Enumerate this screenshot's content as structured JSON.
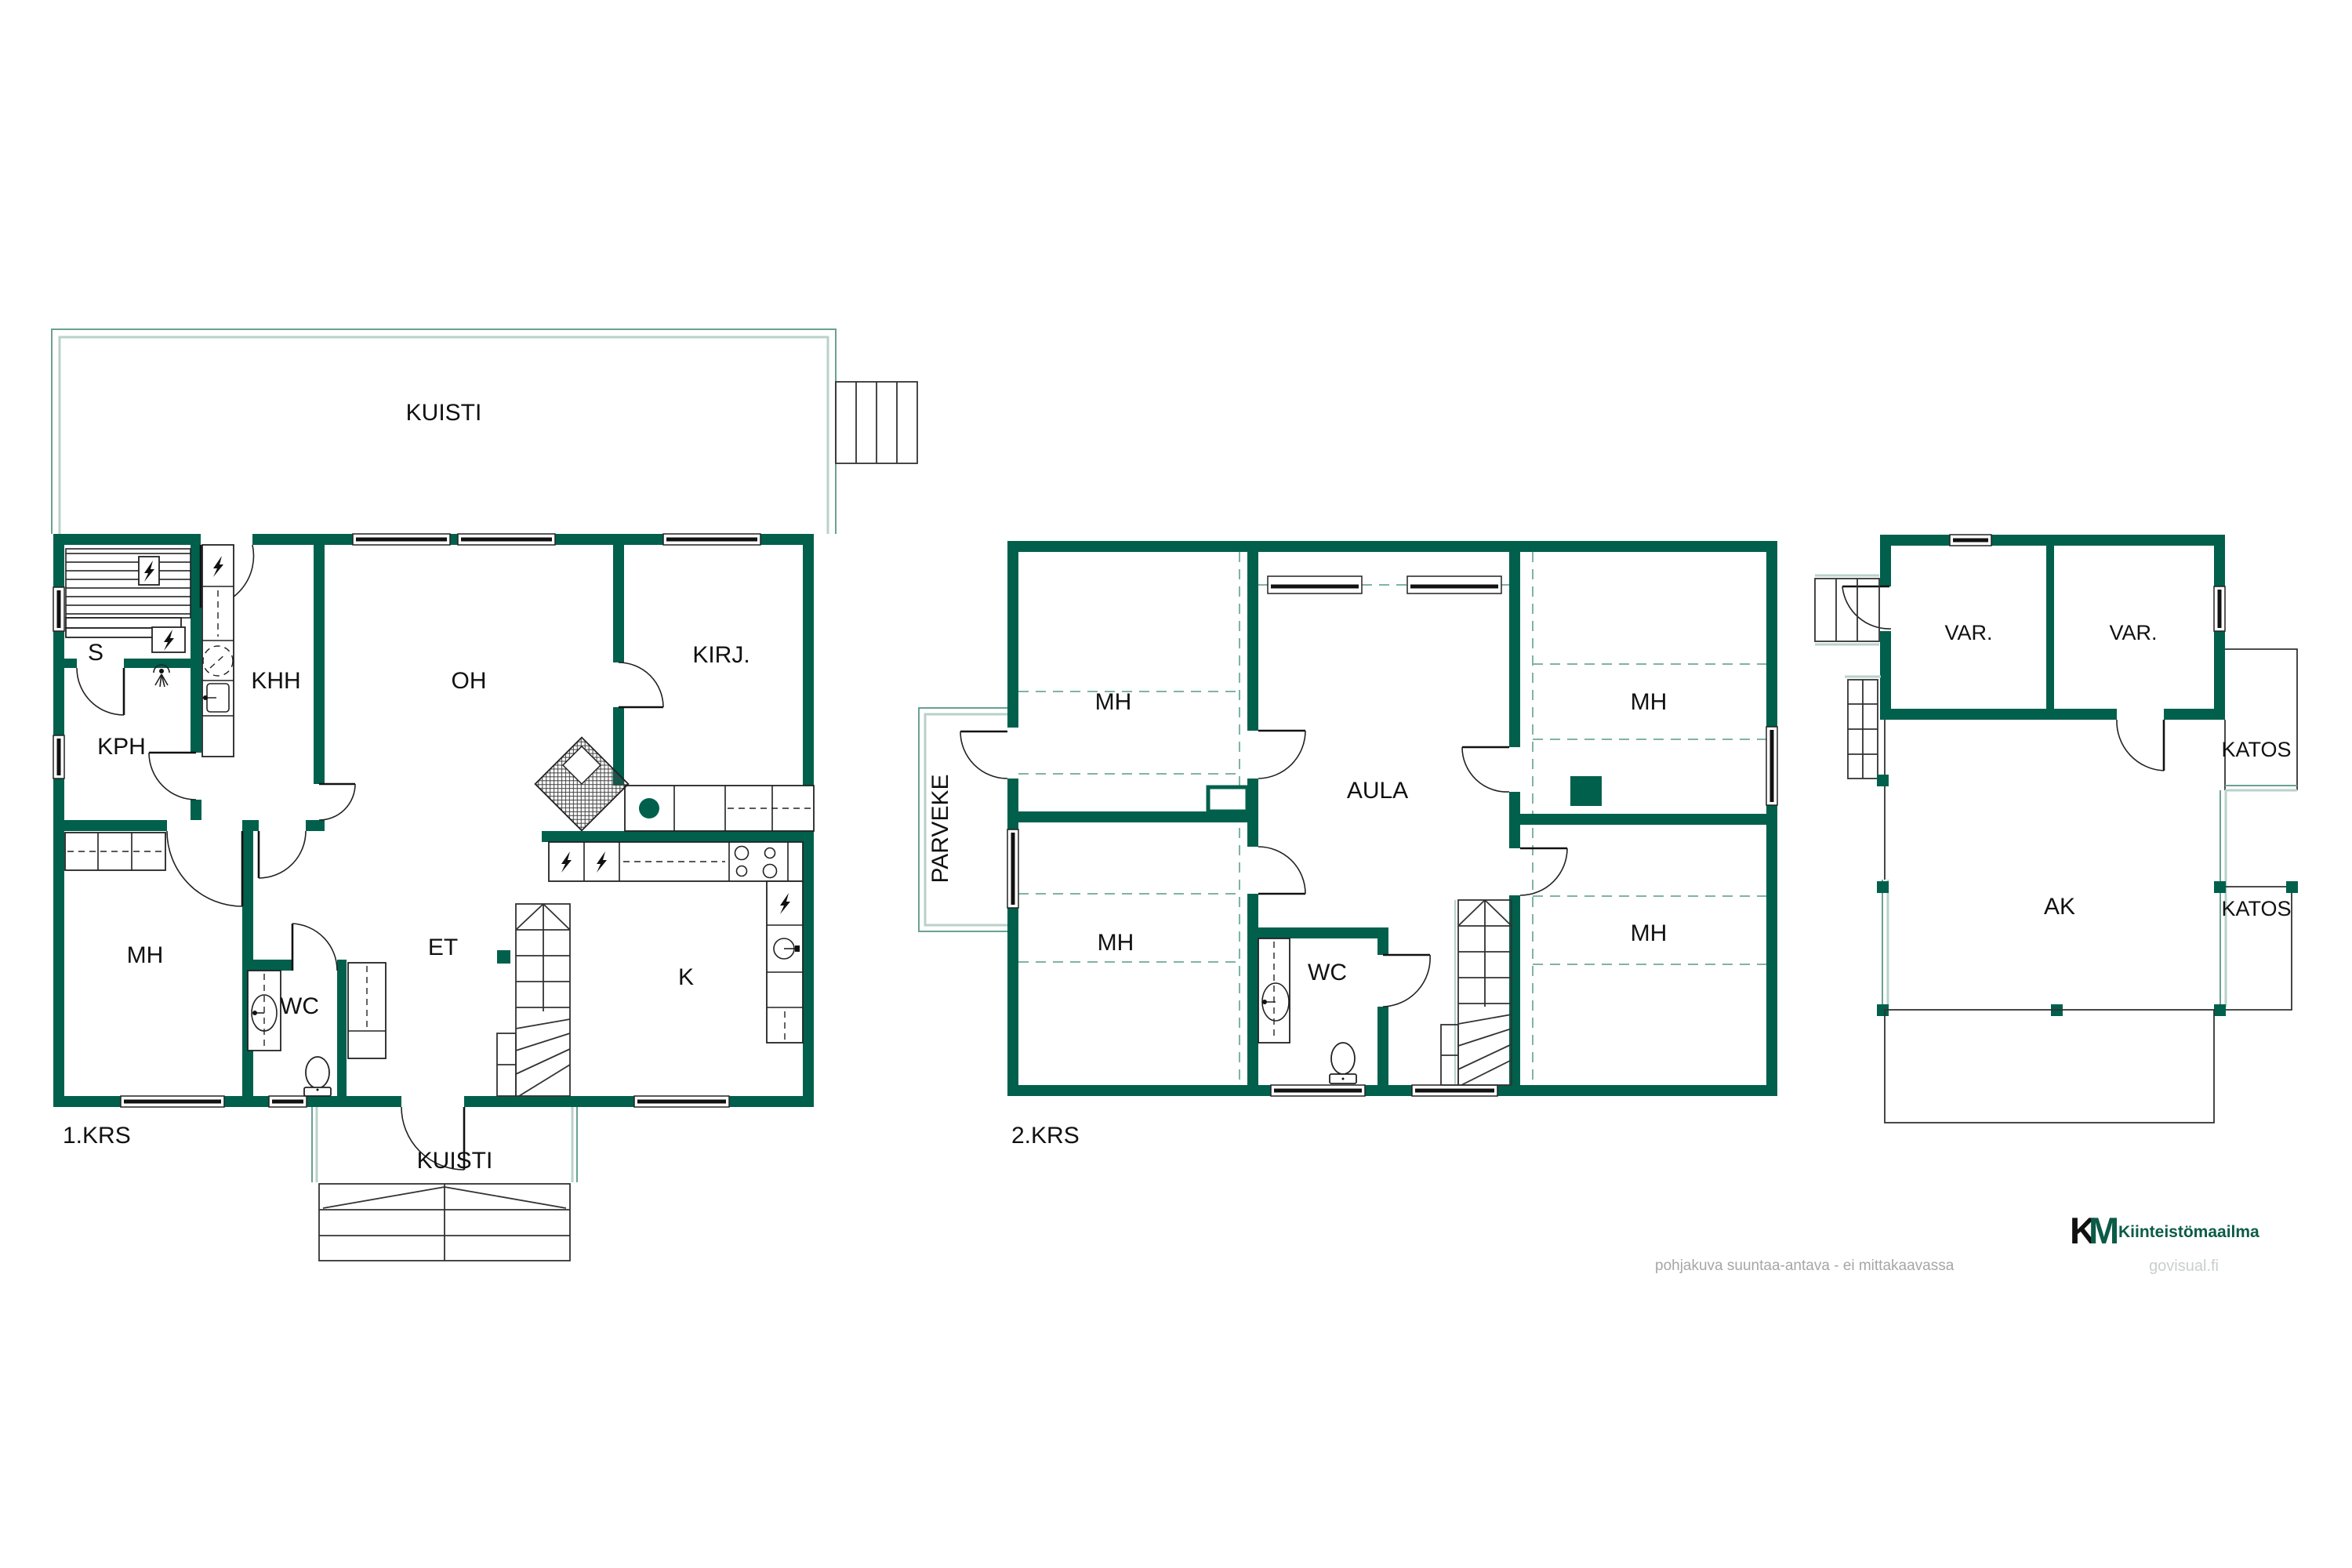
{
  "floor1": {
    "name": "1.KRS",
    "rooms": {
      "kuisti_top": "KUISTI",
      "s": "S",
      "kph": "KPH",
      "khh": "KHH",
      "oh": "OH",
      "kirj": "KIRJ.",
      "mh": "MH",
      "wc": "WC",
      "et": "ET",
      "k": "K",
      "kuisti_bottom": "KUISTI"
    }
  },
  "floor2": {
    "name": "2.KRS",
    "rooms": {
      "parveke": "PARVEKE",
      "mh_top_left": "MH",
      "mh_top_right": "MH",
      "aula": "AULA",
      "mh_bottom_left": "MH",
      "mh_bottom_right": "MH",
      "wc": "WC"
    }
  },
  "outbuilding": {
    "rooms": {
      "var_left": "VAR.",
      "var_right": "VAR.",
      "katos_top": "KATOS",
      "katos_bottom": "KATOS",
      "ak": "AK"
    }
  },
  "footer": {
    "disclaimer": "pohjakuva suuntaa-antava - ei mittakaavassa",
    "logo_k": "K",
    "logo_m": "M",
    "brand": "Kiinteistömaailma",
    "website": "govisual.fi"
  },
  "colors": {
    "wall": "#00604C",
    "accent_outline": "#69A193",
    "accent_light": "#B9D2C9",
    "dashed_line": "#7FB3A6",
    "logo_green_dark": "#0B5C46",
    "logo_green_light": "#38B27C",
    "disclaimer_text": "#A6A6A6",
    "website_text": "#C9CFCF"
  }
}
